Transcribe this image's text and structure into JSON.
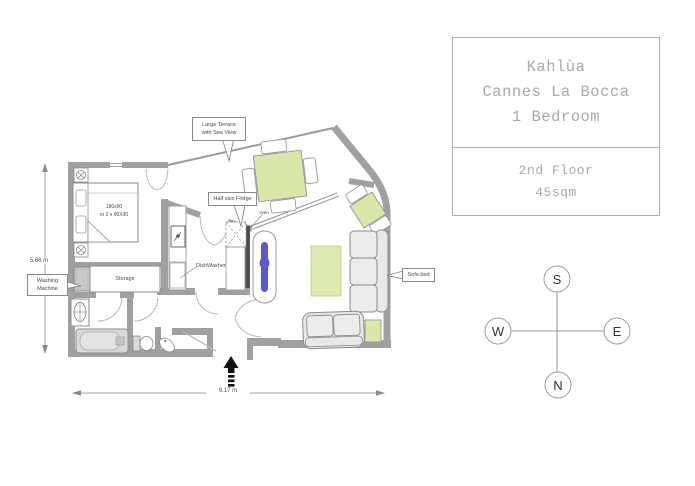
{
  "info_box": {
    "title_line1": "Kahlùa",
    "title_line2": "Cannes La Bocca",
    "title_line3": "1 Bedroom",
    "floor": "2nd Floor",
    "area": "45sqm"
  },
  "callouts": {
    "large_terrace_line1": "Large Terrace",
    "large_terrace_line2": "with Sea View",
    "half_fridge": "Half size Fridge",
    "washing_machine_line1": "Washing",
    "washing_machine_line2": "Machine",
    "sofa_bed": "Sofa bed"
  },
  "labels": {
    "bed_size_line1": "180x90",
    "bed_size_line2": "or 2 x 90X90",
    "storage": "Storage",
    "dishwasher": "DishWasher",
    "oven": "oven"
  },
  "dimensions": {
    "width_label": "9.17 m",
    "height_label": "5.66 m"
  },
  "compass": {
    "top": "S",
    "left": "W",
    "right": "E",
    "bottom": "N"
  },
  "colors": {
    "wall_gray": "#a0a0a0",
    "furniture_green": "#d9e8a8",
    "rug_green": "#ddeab2",
    "accent_blue": "#5b5bd0",
    "info_text_gray": "#a9a9a9"
  }
}
